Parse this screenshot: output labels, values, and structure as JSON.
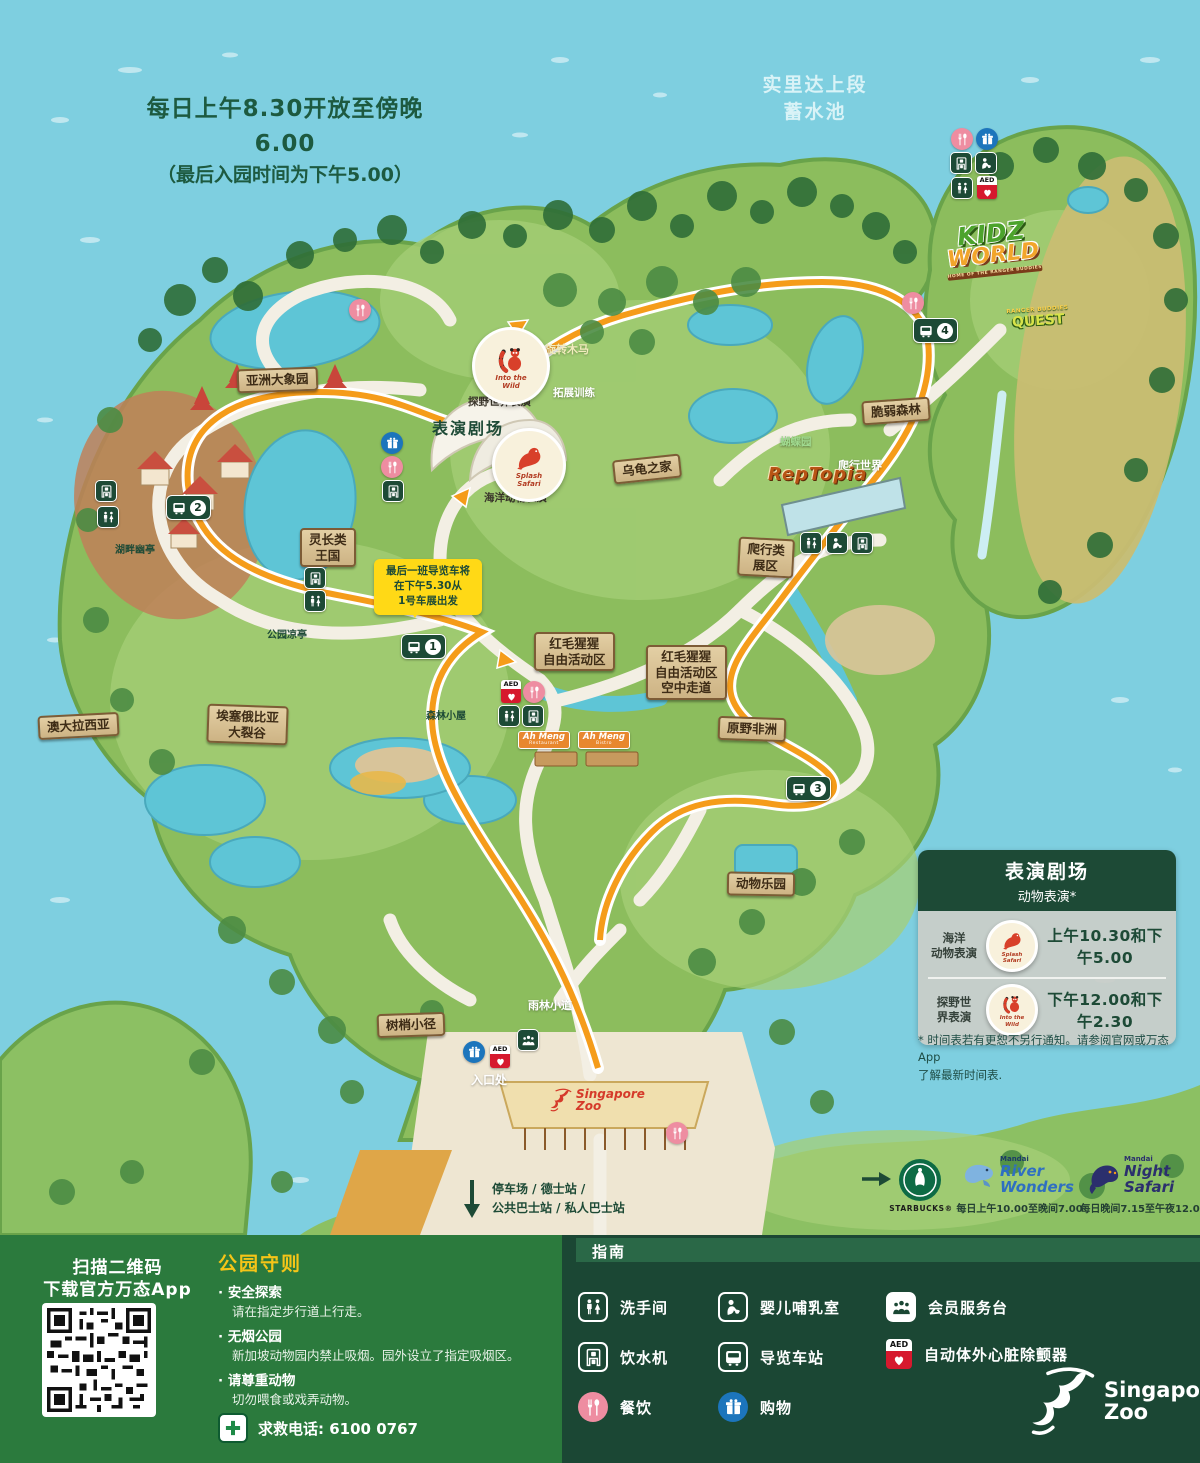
{
  "map": {
    "hours": [
      "每日上午8.30开放至傍晚6.00",
      "（最后入园时间为下午5.00）"
    ],
    "reservoir": [
      "实里达上段",
      "蓄水池"
    ],
    "signs": {
      "asian_elephants": [
        "亚洲大象园"
      ],
      "primate_kingdom": [
        "灵长类",
        "王国"
      ],
      "tortoise_shelter": [
        "乌龟之家"
      ],
      "fragile_forest": [
        "脆弱森林"
      ],
      "reptile_garden": [
        "爬行类",
        "展区"
      ],
      "orangutan_freeranging": [
        "红毛猩猩",
        "自由活动区"
      ],
      "orangutan_boardwalk": [
        "红毛猩猩",
        "自由活动区",
        "空中走道"
      ],
      "wild_africa": [
        "原野非洲"
      ],
      "animal_land": [
        "动物乐园"
      ],
      "treetops_trail": [
        "树梢小径"
      ],
      "rift_valley": [
        "埃塞俄比亚",
        "大裂谷"
      ],
      "australasia": [
        "澳大拉西亚"
      ]
    },
    "texts": {
      "lakeside_pavilion": "湖畔幽亭",
      "park_pavilion": "公园凉亭",
      "forest_lodge": "森林小屋",
      "rainforest_walk": "雨林小道",
      "entrance": "入口处",
      "carousel": "旋转木马",
      "ropes_course": "拓展训练",
      "butterfly_garden": "蝴蝶园",
      "reptile_world": "爬行世界",
      "amphitheatre": "表演剧场",
      "into_wild_show": "探野世界表演",
      "splash_show": "海洋动物表演"
    },
    "badges": {
      "into_wild": [
        "Into the",
        "Wild"
      ],
      "splash": [
        "Splash",
        "Safari"
      ]
    },
    "logos": {
      "kidzworld": [
        "KIDZ",
        "WORLD"
      ],
      "kidzworld_tag": "HOME OF THE RANGER BUDDIES",
      "ranger_quest": [
        "RANGER BUDDIES",
        "QUEST"
      ],
      "reptopia": "RepTopia",
      "ahmeng_restaurant": [
        "Ah Meng",
        "Restaurant"
      ],
      "ahmeng_bistro": [
        "Ah Meng",
        "Bistro"
      ],
      "entrance_zoo": [
        "Singapore",
        "Zoo"
      ]
    },
    "callout": [
      "最后一班导览车将",
      "在下午5.30从",
      "1号车展出发"
    ],
    "transport": [
      "停车场 / 德士站 /",
      "公共巴士站 / 私人巴士站"
    ],
    "tram_stops": [
      "1",
      "2",
      "3",
      "4"
    ],
    "partners": {
      "starbucks": "STARBUCKS®",
      "river_wonders": [
        "Mandai",
        "River",
        "Wonders"
      ],
      "river_hours": "每日上午10.00至晚间7.00",
      "night_safari": [
        "Mandai",
        "Night",
        "Safari"
      ],
      "night_hours": "每日晚间7.15至午夜12.00"
    }
  },
  "show_panel": {
    "title": "表演剧场",
    "subtitle": "动物表演*",
    "rows": [
      {
        "label": [
          "海洋",
          "动物表演"
        ],
        "badge": [
          "Splash",
          "Safari"
        ],
        "time": "上午10.30和下午5.00"
      },
      {
        "label": [
          "探野世",
          "界表演"
        ],
        "badge": [
          "Into the",
          "Wild"
        ],
        "time": "下午12.00和下午2.30"
      }
    ],
    "footnote": [
      "* 时间表若有更恕不另行通知。请参阅官网或万态App",
      "了解最新时间表."
    ]
  },
  "icons": {
    "aed": "AED"
  },
  "footer": {
    "qr_caption": [
      "扫描二维码",
      "下载官方万态App"
    ],
    "rules_title": "公园守则",
    "rules": [
      {
        "title": "安全探索",
        "desc": "请在指定步行道上行走。"
      },
      {
        "title": "无烟公园",
        "desc": "新加坡动物园内禁止吸烟。园外设立了指定吸烟区。"
      },
      {
        "title": "请尊重动物",
        "desc": "切勿喂食或戏弄动物。"
      }
    ],
    "emergency": "求救电话: 6100 0767",
    "legend_title": "指南",
    "legend": [
      {
        "icon": "restroom",
        "label": "洗手间"
      },
      {
        "icon": "baby",
        "label": "婴儿哺乳室"
      },
      {
        "icon": "member",
        "label": "会员服务台"
      },
      {
        "icon": "drink",
        "label": "饮水机"
      },
      {
        "icon": "tram",
        "label": "导览车站"
      },
      {
        "icon": "aed",
        "label": "自动体外心脏除颤器"
      },
      {
        "icon": "dining",
        "label": "餐饮"
      },
      {
        "icon": "shopping",
        "label": "购物"
      }
    ],
    "brand": [
      "Singapore",
      "Zoo"
    ]
  },
  "colors": {
    "accent_orange": "#f59c1a",
    "dark_green": "#1c4a36",
    "water_blue": "#7ecfe0",
    "panel_green": "#2b7a3d",
    "legend_green": "#1b4734",
    "pink": "#ee8da1",
    "blue": "#1c75bc",
    "aed_red": "#d6192e",
    "callout_yellow": "#ffd916"
  }
}
